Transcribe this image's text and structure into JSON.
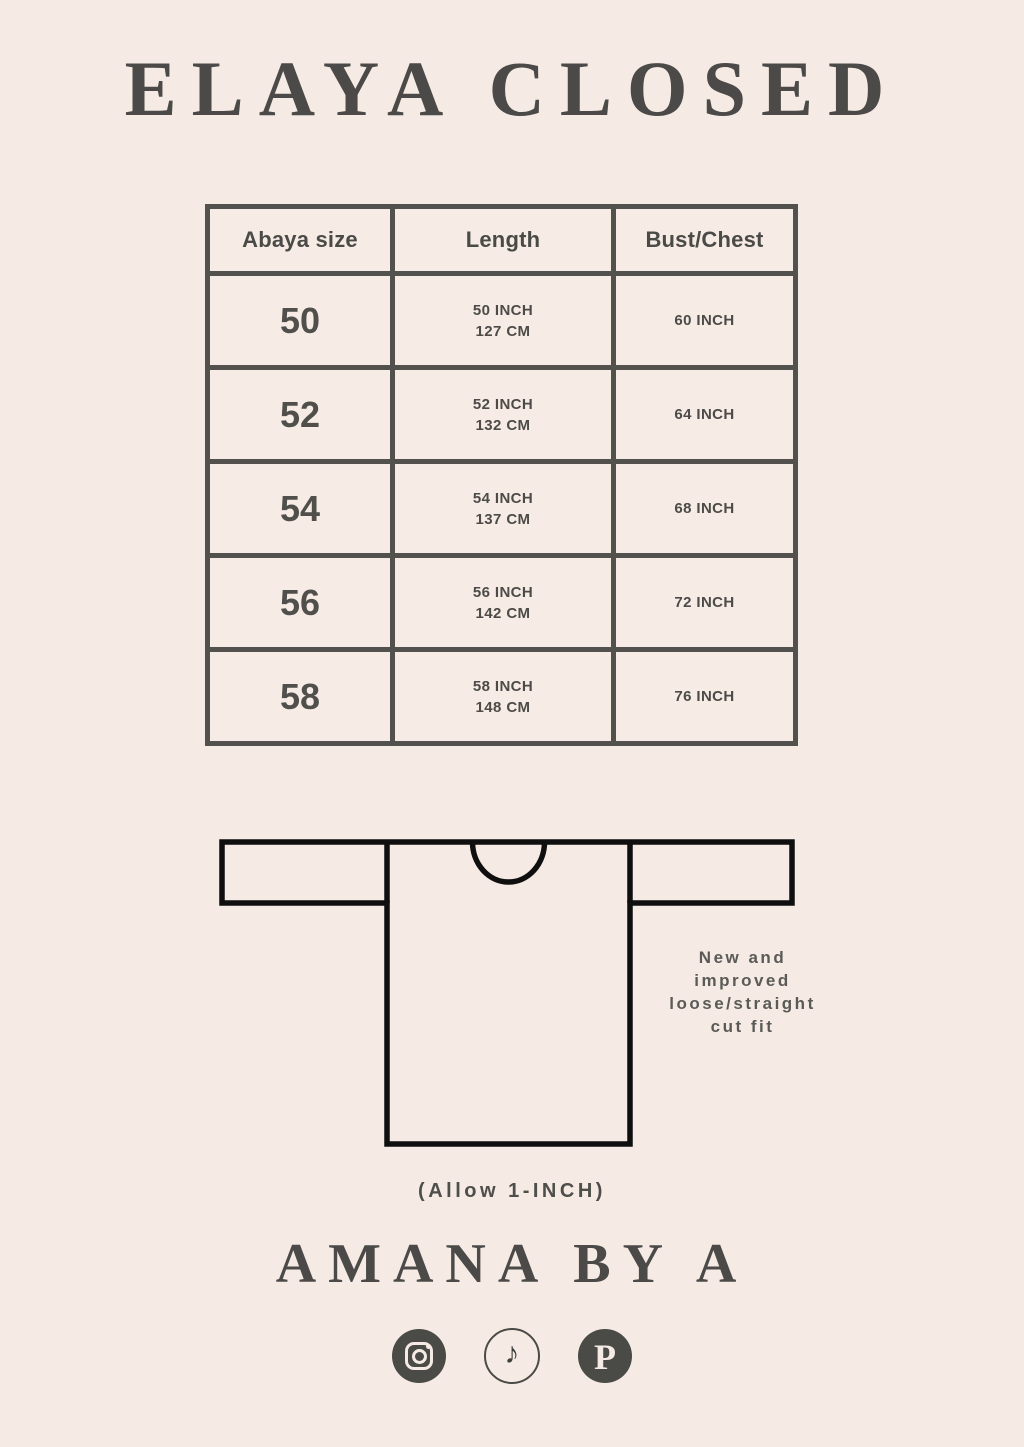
{
  "page": {
    "title": "ELAYA CLOSED",
    "brand": "AMANA BY A",
    "allowance_note": "(Allow 1-INCH)"
  },
  "size_table": {
    "headers": [
      "Abaya size",
      "Length",
      "Bust/Chest"
    ],
    "rows": [
      {
        "size": "50",
        "length_inch": "50 INCH",
        "length_cm": "127 CM",
        "bust": "60 INCH"
      },
      {
        "size": "52",
        "length_inch": "52 INCH",
        "length_cm": "132 CM",
        "bust": "64 INCH"
      },
      {
        "size": "54",
        "length_inch": "54 INCH",
        "length_cm": "137 CM",
        "bust": "68 INCH"
      },
      {
        "size": "56",
        "length_inch": "56 INCH",
        "length_cm": "142 CM",
        "bust": "72 INCH"
      },
      {
        "size": "58",
        "length_inch": "58 INCH",
        "length_cm": "148 CM",
        "bust": "76 INCH"
      }
    ]
  },
  "diagram": {
    "fit_note": "New and\nimproved\nloose/straight\ncut fit"
  },
  "social": {
    "icons": [
      {
        "name": "instagram-icon",
        "glyph": ""
      },
      {
        "name": "tiktok-icon",
        "glyph": "♪"
      },
      {
        "name": "pinterest-icon",
        "glyph": "P"
      }
    ]
  },
  "colors": {
    "background": "#f6ebe4",
    "table_border": "#53514e",
    "text_dark": "#4a4a47",
    "garment_outline": "#0f0f0f",
    "note_text": "#5a5a57"
  }
}
